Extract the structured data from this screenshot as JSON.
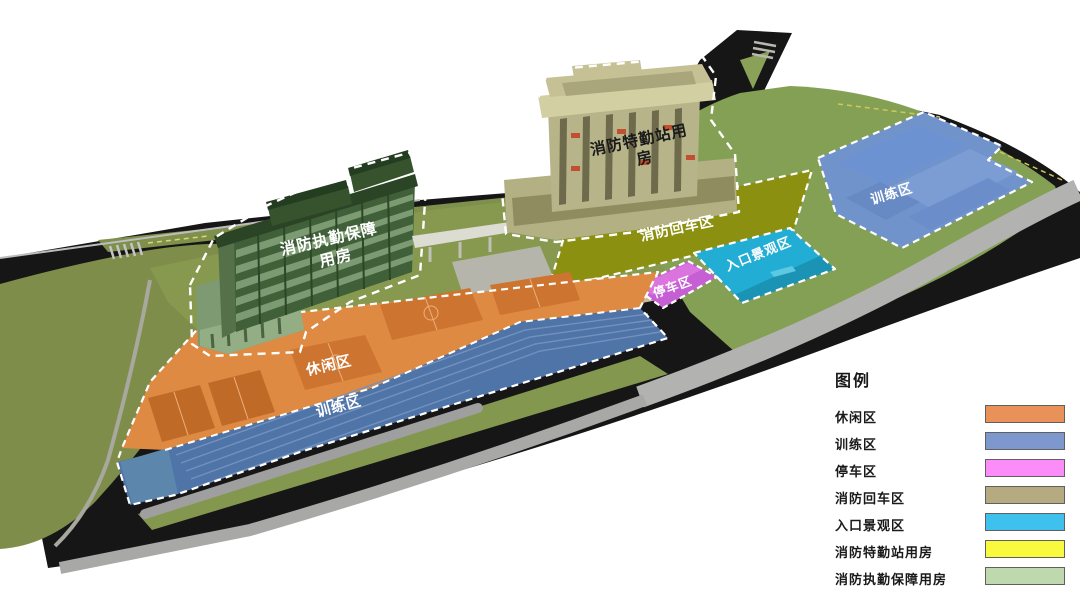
{
  "plan": {
    "buildings": [
      {
        "id": "support",
        "label_line1": "消防执勤保障",
        "label_line2": "用房",
        "color": "#40603a",
        "label_color": "#ffffff"
      },
      {
        "id": "station",
        "label_line1": "消防特勤站用",
        "label_line2": "房",
        "color": "#b7b489",
        "label_color": "#1a1a1a"
      }
    ],
    "zones": [
      {
        "id": "leisure",
        "label": "休闲区",
        "color": "#de8a42"
      },
      {
        "id": "training_bottom",
        "label": "训练区",
        "color": "#4f74a8"
      },
      {
        "id": "training_right",
        "label": "训练区",
        "color": "#7193cc"
      },
      {
        "id": "turnaround",
        "label": "消防回车区",
        "color": "#8b9010"
      },
      {
        "id": "parking",
        "label": "停车区",
        "color": "#c75fd4"
      },
      {
        "id": "entrance",
        "label": "入口景观区",
        "color": "#22aed4"
      }
    ]
  },
  "legend": {
    "title": "图例",
    "items": [
      {
        "label": "休闲区",
        "color": "#e8925a"
      },
      {
        "label": "训练区",
        "color": "#7e97cd"
      },
      {
        "label": "停车区",
        "color": "#fc8cf8"
      },
      {
        "label": "消防回车区",
        "color": "#b6aa80"
      },
      {
        "label": "入口景观区",
        "color": "#3fc1ee"
      },
      {
        "label": "消防特勤站用房",
        "color": "#f9f93e"
      },
      {
        "label": "消防执勤保障用房",
        "color": "#bed9ad"
      }
    ]
  }
}
